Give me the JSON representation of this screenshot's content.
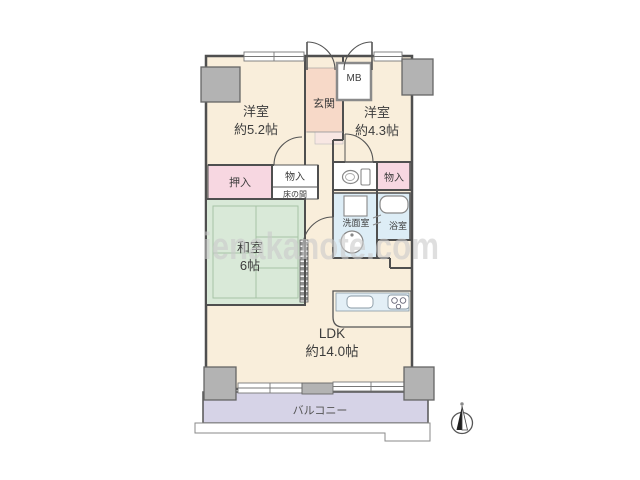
{
  "watermark": "ienakanote.com",
  "rooms": {
    "west1": {
      "name": "洋室",
      "size": "約5.2帖"
    },
    "west2": {
      "name": "洋室",
      "size": "約4.3帖"
    },
    "washitsu": {
      "name": "和室",
      "size": "6帖"
    },
    "ldk": {
      "name": "LDK",
      "size": "約14.0帖"
    }
  },
  "areas": {
    "genkan": "玄関",
    "mb": "MB",
    "oshiire": "押入",
    "monoire_left": "物入",
    "tokonoma": "床の間",
    "monoire_right": "物入",
    "senmenshitsu": "洗面室",
    "yokushitsu": "浴室",
    "balcony": "バルコニー"
  },
  "colors": {
    "room_cream": "#f9eedb",
    "tatami_green": "#d9e9d8",
    "water_blue": "#ddedf6",
    "closet_pink": "#f7d7e1",
    "genkan_pink": "#f7d9c8",
    "genkan_step": "#f8e7e3",
    "balcony_lavender": "#d6d3e7",
    "pillar_gray": "#b3b3b3",
    "wall": "#4f4f4f",
    "watermark_gray": "#cbcbcb"
  }
}
